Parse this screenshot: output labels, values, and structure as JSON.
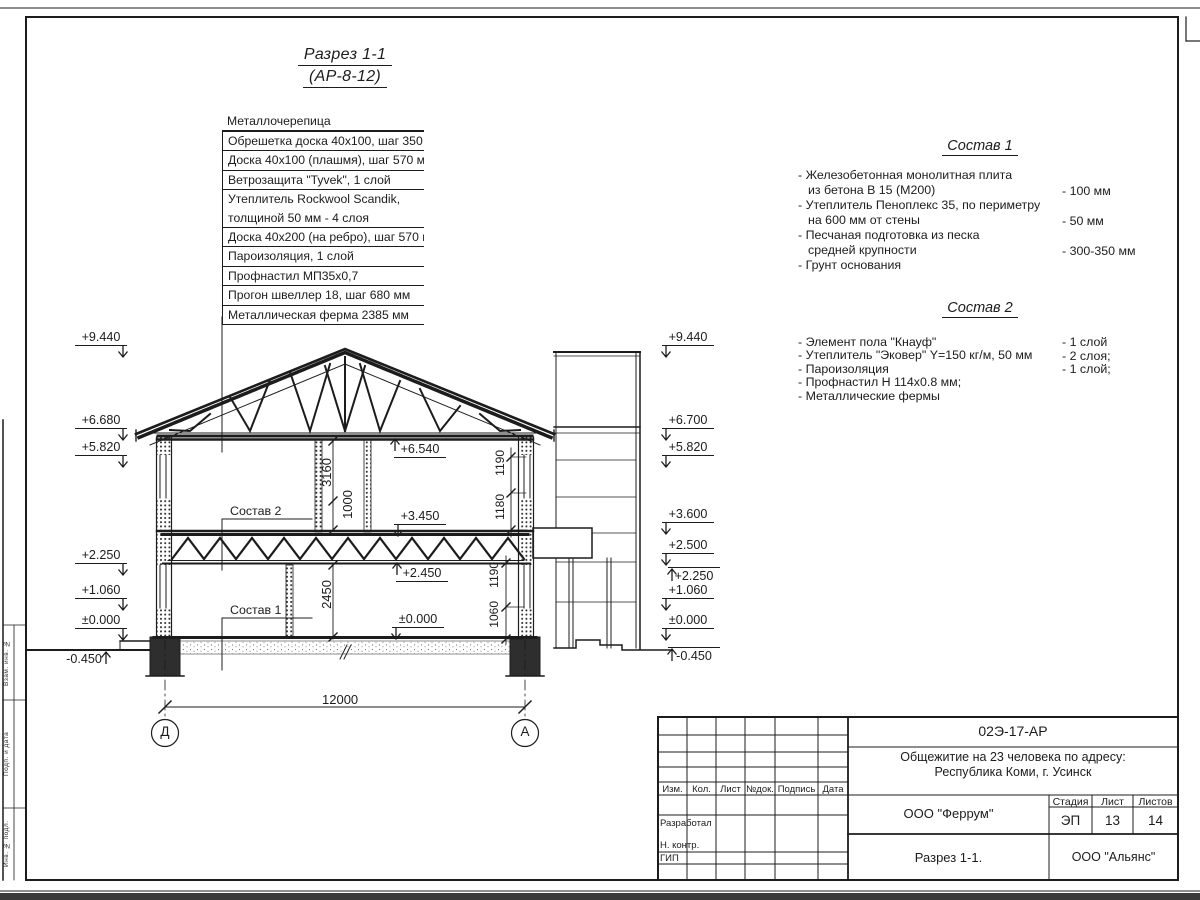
{
  "page": {
    "bg": "#ffffff",
    "ink": "#1c1c1c"
  },
  "title": {
    "line1": "Разрез 1-1",
    "line2": "(АР-8-12)"
  },
  "callout": {
    "header": "Металлочерепица",
    "rows": [
      {
        "text": "Обрешетка доска 40х100, шаг 350 мм",
        "rule": true
      },
      {
        "text": "Доска 40х100 (плашмя), шаг 570 мм",
        "rule": true
      },
      {
        "text": "Ветрозащита \"Tyvek\", 1 слой",
        "rule": true
      },
      {
        "text": "Утеплитель Rockwool Scandik,",
        "rule": true
      },
      {
        "text": "толщиной 50 мм - 4 слоя",
        "rule": false
      },
      {
        "text": "Доска 40х200 (на ребро), шаг 570 мм",
        "rule": true
      },
      {
        "text": "Пароизоляция, 1 слой",
        "rule": true
      },
      {
        "text": "Профнастил МП35х0,7",
        "rule": true
      },
      {
        "text": "Прогон швеллер 18, шаг 680 мм",
        "rule": true
      },
      {
        "text": "Металлическая ферма 2385 мм",
        "rule": true
      }
    ]
  },
  "sostav1": {
    "title": "Состав 1",
    "items": [
      {
        "lines": [
          "- Железобетонная  монолитная плита",
          "из бетона В 15 (М200)"
        ],
        "value": "- 100 мм"
      },
      {
        "lines": [
          "- Утеплитель Пеноплекс 35, по периметру",
          "на 600 мм от стены"
        ],
        "value": "- 50 мм"
      },
      {
        "lines": [
          "- Песчаная подготовка из песка",
          "средней крупности"
        ],
        "value": "- 300-350 мм"
      },
      {
        "lines": [
          "- Грунт основания"
        ],
        "value": ""
      }
    ]
  },
  "sostav2": {
    "title": "Состав 2",
    "items": [
      {
        "lines": [
          "- Элемент пола \"Кнауф\""
        ],
        "value": "- 1 слой"
      },
      {
        "lines": [
          "- Утеплитель \"Эковер\" Y=150 кг/м, 50 мм"
        ],
        "value": "- 2 слоя;"
      },
      {
        "lines": [
          "- Пароизоляция"
        ],
        "value": "- 1 слой;"
      },
      {
        "lines": [
          "- Профнастил Н 114х0.8 мм;"
        ],
        "value": ""
      },
      {
        "lines": [
          "- Металлические фермы"
        ],
        "value": ""
      }
    ]
  },
  "section_refs": {
    "sostav2": "Состав 2",
    "sostav1": "Состав 1"
  },
  "elevation_marks": [
    {
      "v": "+9.440",
      "x": 75,
      "y": 330,
      "cls": "r"
    },
    {
      "v": "+6.680",
      "x": 75,
      "y": 413,
      "cls": "r"
    },
    {
      "v": "+5.820",
      "x": 75,
      "y": 440,
      "cls": "r"
    },
    {
      "v": "+2.250",
      "x": 75,
      "y": 548,
      "cls": "r"
    },
    {
      "v": "+1.060",
      "x": 75,
      "y": 583,
      "cls": "r"
    },
    {
      "v": "±0.000",
      "x": 75,
      "y": 613,
      "cls": "r"
    },
    {
      "v": "-0.450",
      "x": 58,
      "y": 650,
      "cls": "r tl au"
    },
    {
      "v": "+9.440",
      "x": 662,
      "y": 330,
      "cls": "l"
    },
    {
      "v": "+6.700",
      "x": 662,
      "y": 413,
      "cls": "l"
    },
    {
      "v": "+5.820",
      "x": 662,
      "y": 440,
      "cls": "l"
    },
    {
      "v": "+3.600",
      "x": 662,
      "y": 507,
      "cls": "l"
    },
    {
      "v": "+2.500",
      "x": 662,
      "y": 538,
      "cls": "l"
    },
    {
      "v": "+2.250",
      "x": 668,
      "y": 567,
      "cls": "l tl au"
    },
    {
      "v": "+1.060",
      "x": 662,
      "y": 583,
      "cls": "l"
    },
    {
      "v": "±0.000",
      "x": 662,
      "y": 613,
      "cls": "l"
    },
    {
      "v": "-0.450",
      "x": 668,
      "y": 647,
      "cls": "l tl au"
    },
    {
      "v": "+6.540",
      "x": 394,
      "y": 442,
      "cls": "l au abv"
    },
    {
      "v": "+3.450",
      "x": 394,
      "y": 509,
      "cls": "l"
    },
    {
      "v": "+2.450",
      "x": 396,
      "y": 566,
      "cls": "l au abv"
    },
    {
      "v": "±0.000",
      "x": 392,
      "y": 612,
      "cls": "l"
    }
  ],
  "dim_labels": [
    {
      "t": "12000",
      "x": 322,
      "y": 692,
      "rot": false,
      "fs": 13
    },
    {
      "t": "3160",
      "x": 320,
      "y": 458,
      "rot": true,
      "fs": 13
    },
    {
      "t": "1000",
      "x": 341,
      "y": 490,
      "rot": true,
      "fs": 13
    },
    {
      "t": "2450",
      "x": 320,
      "y": 580,
      "rot": true,
      "fs": 13
    },
    {
      "t": "1190",
      "x": 493,
      "y": 450,
      "rot": true,
      "fs": 12
    },
    {
      "t": "1180",
      "x": 493,
      "y": 494,
      "rot": true,
      "fs": 12
    },
    {
      "t": "1190",
      "x": 487,
      "y": 562,
      "rot": true,
      "fs": 12
    },
    {
      "t": "1060",
      "x": 487,
      "y": 601,
      "rot": true,
      "fs": 12
    }
  ],
  "axes": [
    {
      "label": "Д",
      "x": 165,
      "y": 733
    },
    {
      "label": "А",
      "x": 525,
      "y": 733
    }
  ],
  "titleblock": {
    "code": "02Э-17-АР",
    "project_line1": "Общежитие на 23 человека по адресу:",
    "project_line2": "Республика Коми, г. Усинск",
    "org": "ООО \"Феррум\"",
    "stage_label": "Стадия",
    "sheet_label": "Лист",
    "sheets_label": "Листов",
    "stage": "ЭП",
    "sheet": "13",
    "sheets": "14",
    "drawing_name": "Разрез 1-1.",
    "org2": "ООО \"Альянс\"",
    "col_headers": [
      "Изм.",
      "Кол.",
      "Лист",
      "№док.",
      "Подпись",
      "Дата"
    ],
    "role_1": "Разработал",
    "role_2": "Н. контр.",
    "role_3": "ГИП"
  },
  "frame_side_labels": [
    "Взам. инв. №",
    "Подп. и дата",
    "Инв. № подл."
  ]
}
